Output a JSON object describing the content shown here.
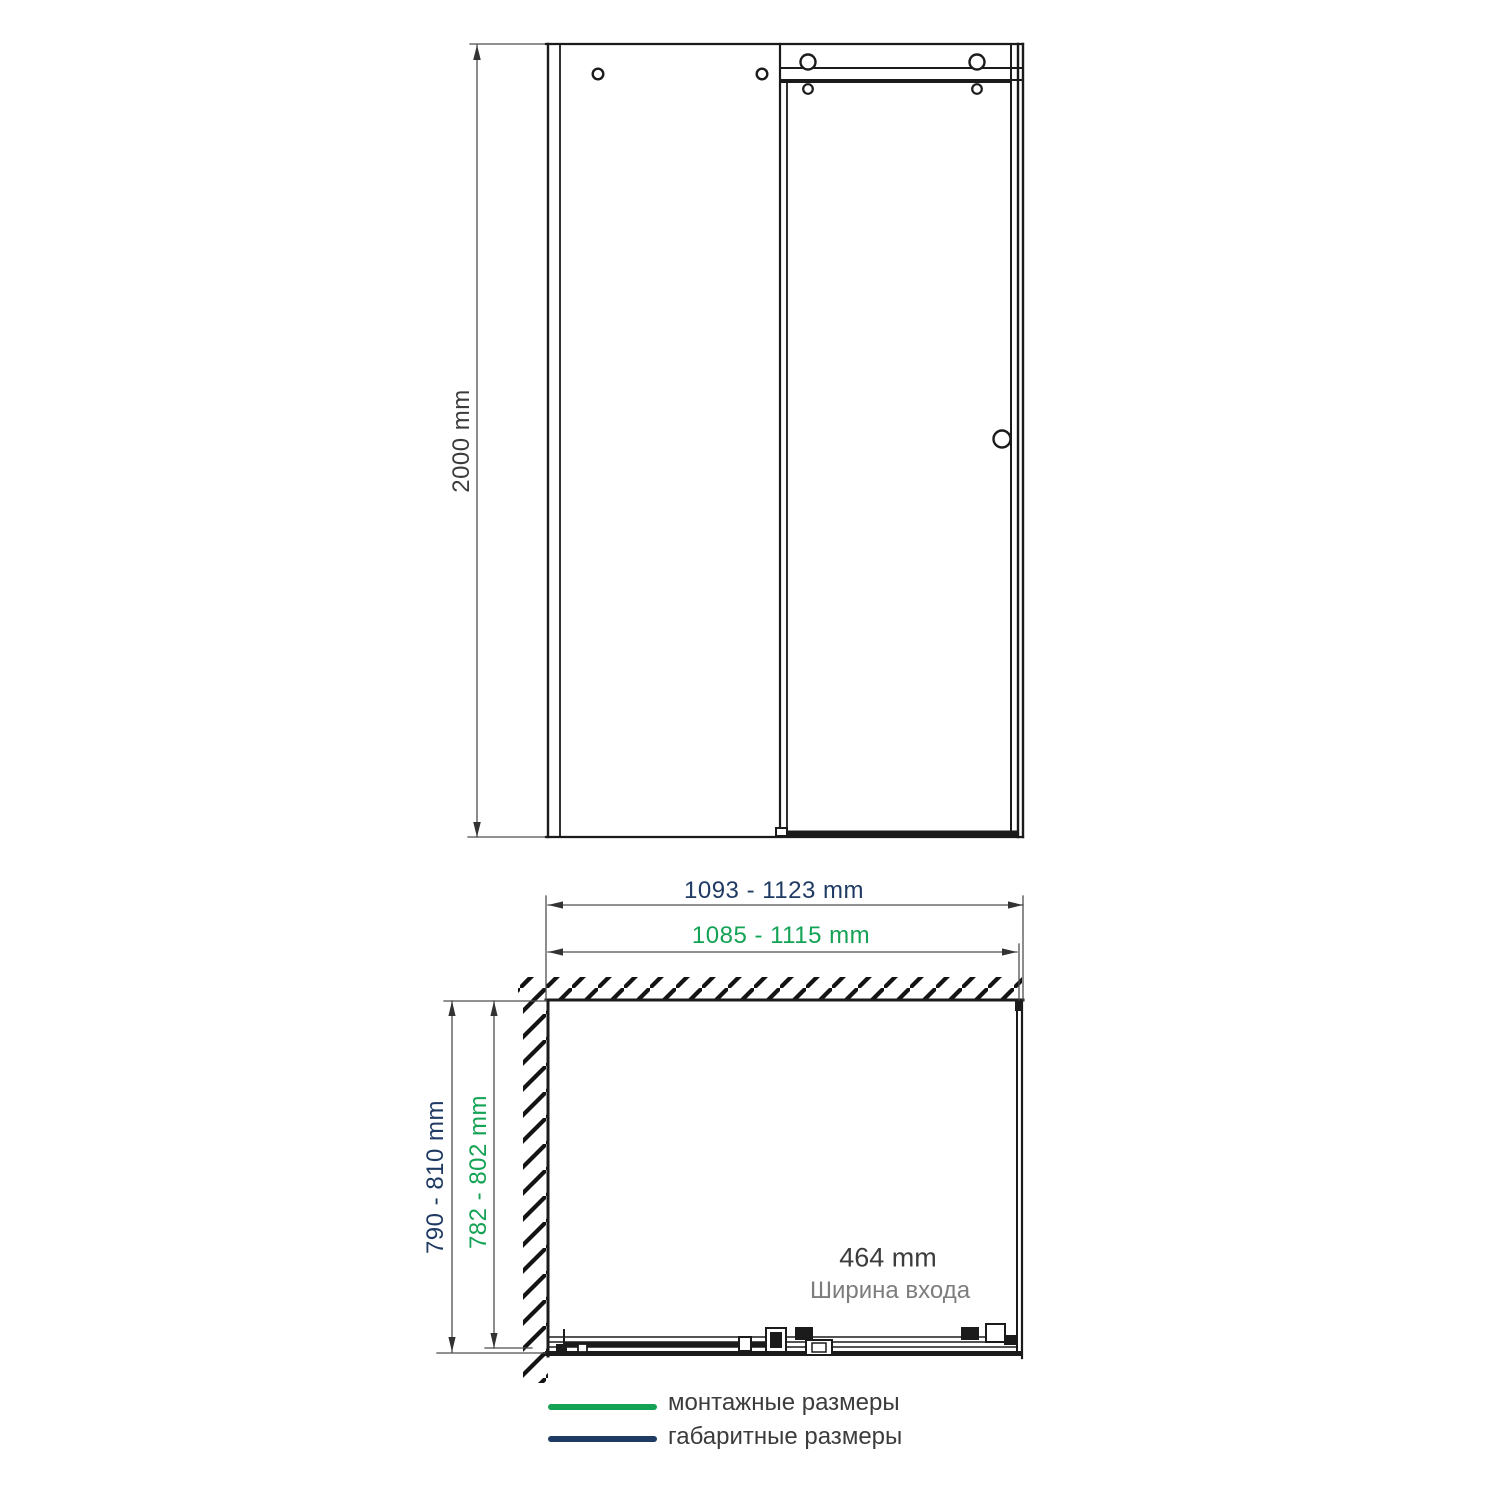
{
  "front_view": {
    "height_dim": "2000 mm"
  },
  "plan_view": {
    "overall_width_dim": "1093 - 1123 mm",
    "mounting_width_dim": "1085 - 1115 mm",
    "overall_depth_dim": "790 - 810 mm",
    "mounting_depth_dim": "782 - 802 mm",
    "entry_width_value": "464 mm",
    "entry_width_caption": "Ширина входа"
  },
  "legend": {
    "items": [
      {
        "label": "монтажные размеры",
        "color": "#14a254"
      },
      {
        "label": "габаритные размеры",
        "color": "#1f3a63"
      }
    ]
  },
  "colors": {
    "mounting_green": "#14a254",
    "overall_navy": "#1f3a63",
    "drawing_line": "#1b1b1b",
    "dimension_line": "#4d4d4d",
    "dim_text_dark": "#3c3c3c",
    "caption_gray": "#7d7d7d"
  }
}
